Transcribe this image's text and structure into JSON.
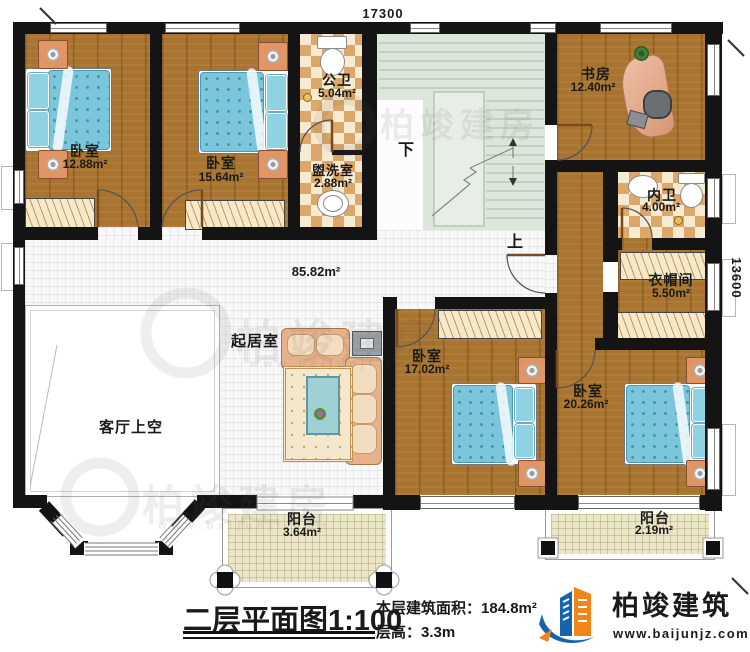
{
  "plan": {
    "dimensions": {
      "width_mm": "17300",
      "height_mm": "13600"
    },
    "rooms": {
      "bedroom_a": {
        "name": "卧室",
        "area": "12.88m²"
      },
      "bedroom_b": {
        "name": "卧室",
        "area": "15.64m²"
      },
      "public_bath": {
        "name": "公卫",
        "area": "5.04m²"
      },
      "washroom": {
        "name": "盥洗室",
        "area": "2.88m²"
      },
      "study": {
        "name": "书房",
        "area": "12.40m²"
      },
      "ensuite_bath": {
        "name": "内卫",
        "area": "4.00m²"
      },
      "cloakroom": {
        "name": "衣帽间",
        "area": "5.50m²"
      },
      "living_room": {
        "name": "起居室",
        "area": "85.82m²"
      },
      "living_void": {
        "name": "客厅上空"
      },
      "bedroom_c": {
        "name": "卧室",
        "area": "17.02m²"
      },
      "bedroom_d": {
        "name": "卧室",
        "area": "20.26m²"
      },
      "balcony_front": {
        "name": "阳台",
        "area": "3.64m²"
      },
      "balcony_rear": {
        "name": "阳台",
        "area": "2.19m²"
      }
    },
    "stairs": {
      "down_label": "下",
      "up_label": "上"
    }
  },
  "title_block": {
    "title": "二层平面图",
    "scale": "1:100",
    "floor_area_label": "本层建筑面积：",
    "floor_area_value": "184.8m²",
    "floor_height_label": "层高：",
    "floor_height_value": "3.3m"
  },
  "branding": {
    "logo_text": "柏竣建筑",
    "logo_url": "www.baijunjz.com",
    "watermark_text": "柏竣建房",
    "watermark_url": "www.baijunjf.com"
  }
}
